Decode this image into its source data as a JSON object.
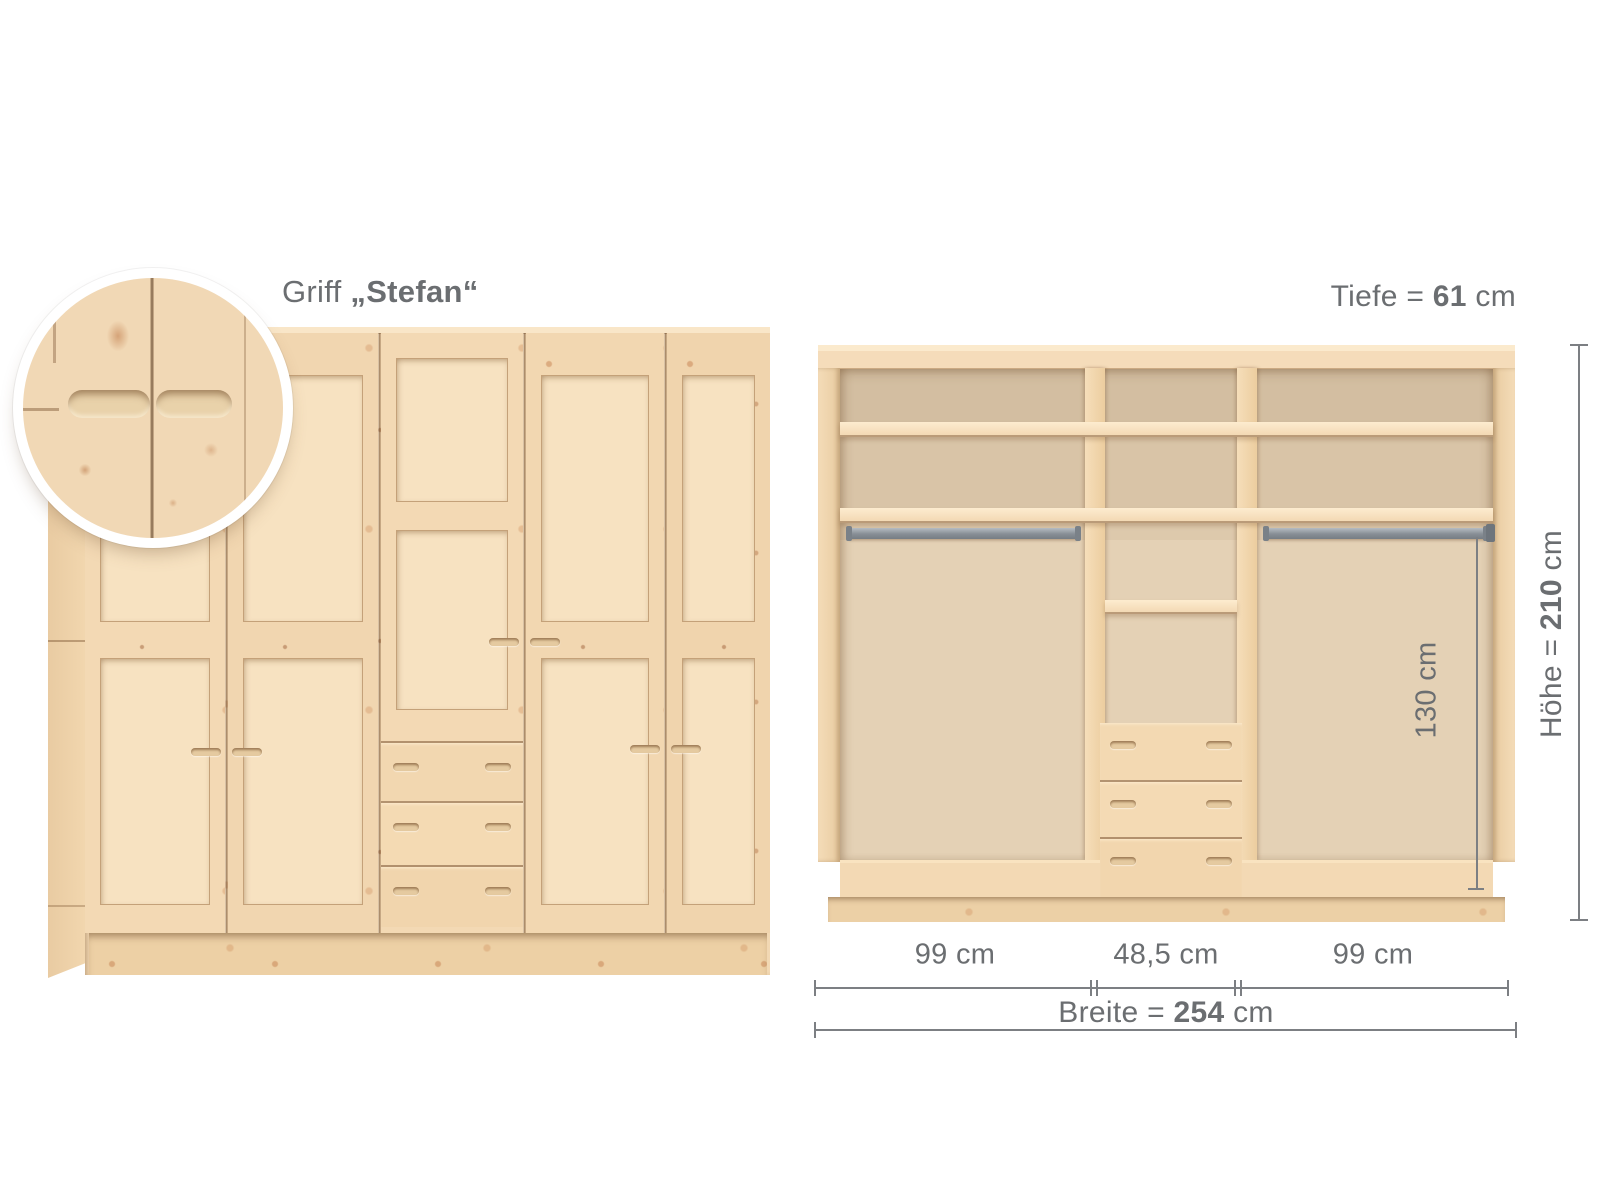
{
  "annotations": {
    "handle": {
      "prefix": "Griff ",
      "name": "„Stefan“"
    },
    "depth": {
      "prefix": "Tiefe = ",
      "value": "61",
      "unit": " cm"
    },
    "height": {
      "prefix": "Höhe = ",
      "value": "210",
      "unit": " cm"
    },
    "inner_height": {
      "value": "130 cm"
    },
    "compartment_widths": [
      "99 cm",
      "48,5 cm",
      "99 cm"
    ],
    "total_width": {
      "prefix": "Breite = ",
      "value": "254",
      "unit": " cm"
    }
  },
  "colors": {
    "background": "#ffffff",
    "text_gray": "#6b6e71",
    "dim_line": "#7c7f83",
    "wood_light": "#f6e0bf",
    "wood_mid": "#f0d5ae",
    "wood_dark": "#e3c59a",
    "interior_back": "#dcc7ab",
    "rail_gray": "#878e95"
  }
}
